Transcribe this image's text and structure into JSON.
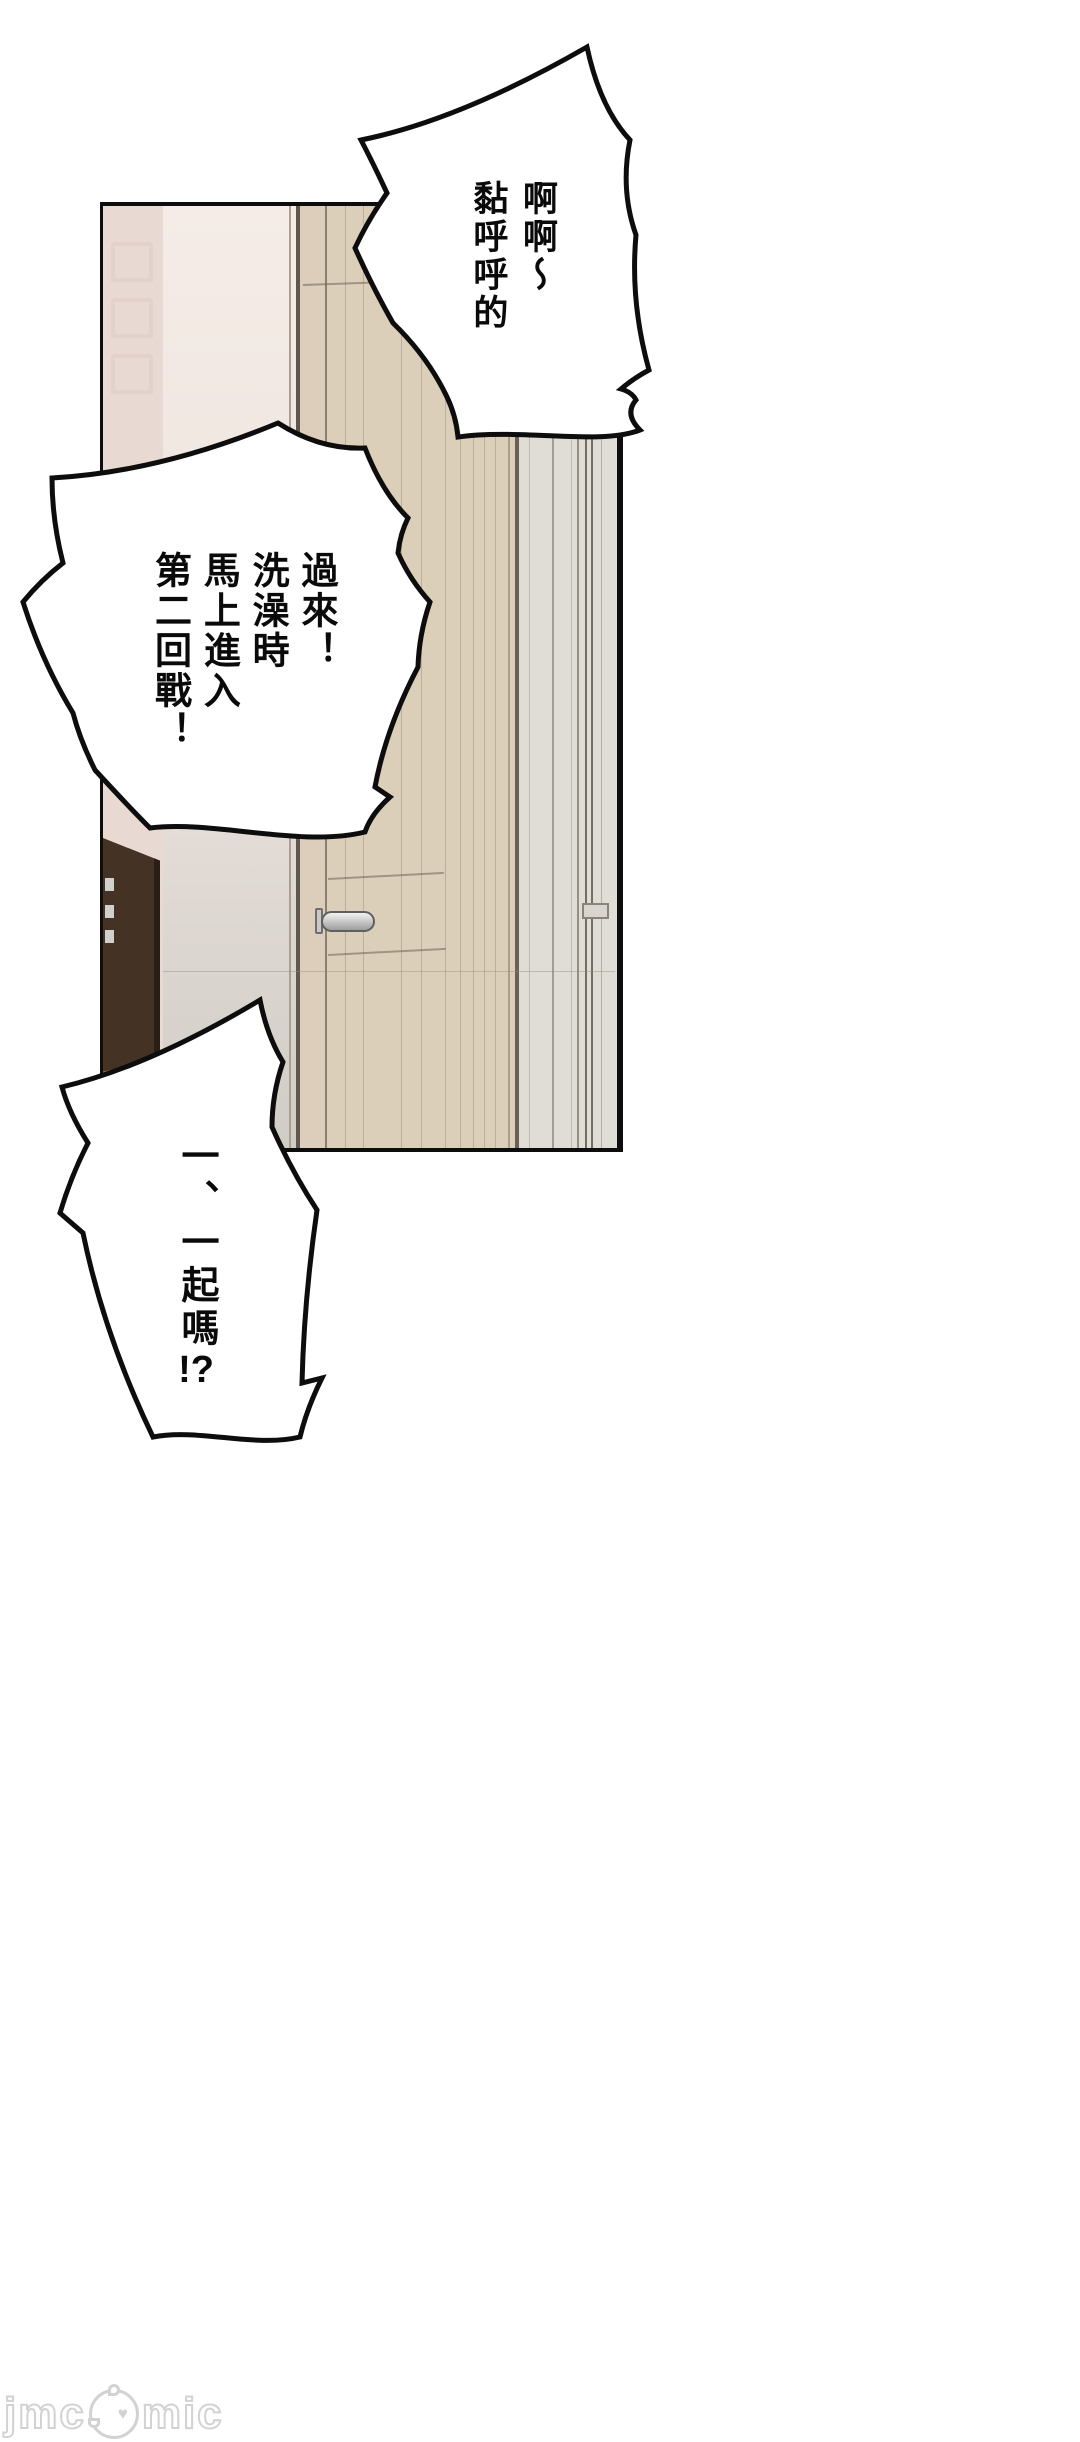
{
  "palette": {
    "page-bg": "#ffffff",
    "line-black": "#0d0d0d",
    "bubble-fill": "#ffffff",
    "wall-pink": "#e8dad3",
    "wall-pattern": "#dfccc4",
    "wall-light": "#f5ece7",
    "wall-gray": "#d0ccc6",
    "door-beige": "#dccfba",
    "frame-beige": "#dccebb",
    "frame-dark": "#5f5850",
    "gray-door": "#e0dcd6",
    "cabinet-brown": "#443324",
    "cabinet-shadow": "#2a1f16",
    "floor-brown": "#ad7a4e",
    "handle-light": "#f2f2f2",
    "handle-dark": "#9e9e9e",
    "watermark-gray": "#d2d2d2"
  },
  "bubbles": [
    {
      "name": "shout-bubble-top-right",
      "lines": [
        "啊啊～",
        "黏呼呼的"
      ]
    },
    {
      "name": "shout-bubble-middle-left",
      "lines": [
        "過來！",
        "洗澡時",
        "馬上進入",
        "第二回戰！"
      ]
    },
    {
      "name": "shout-bubble-bottom-left",
      "lines": [
        "一、一起嗎!?"
      ]
    }
  ],
  "watermark": {
    "part1": "jmc",
    "part2": "mic",
    "heart": "♥"
  }
}
